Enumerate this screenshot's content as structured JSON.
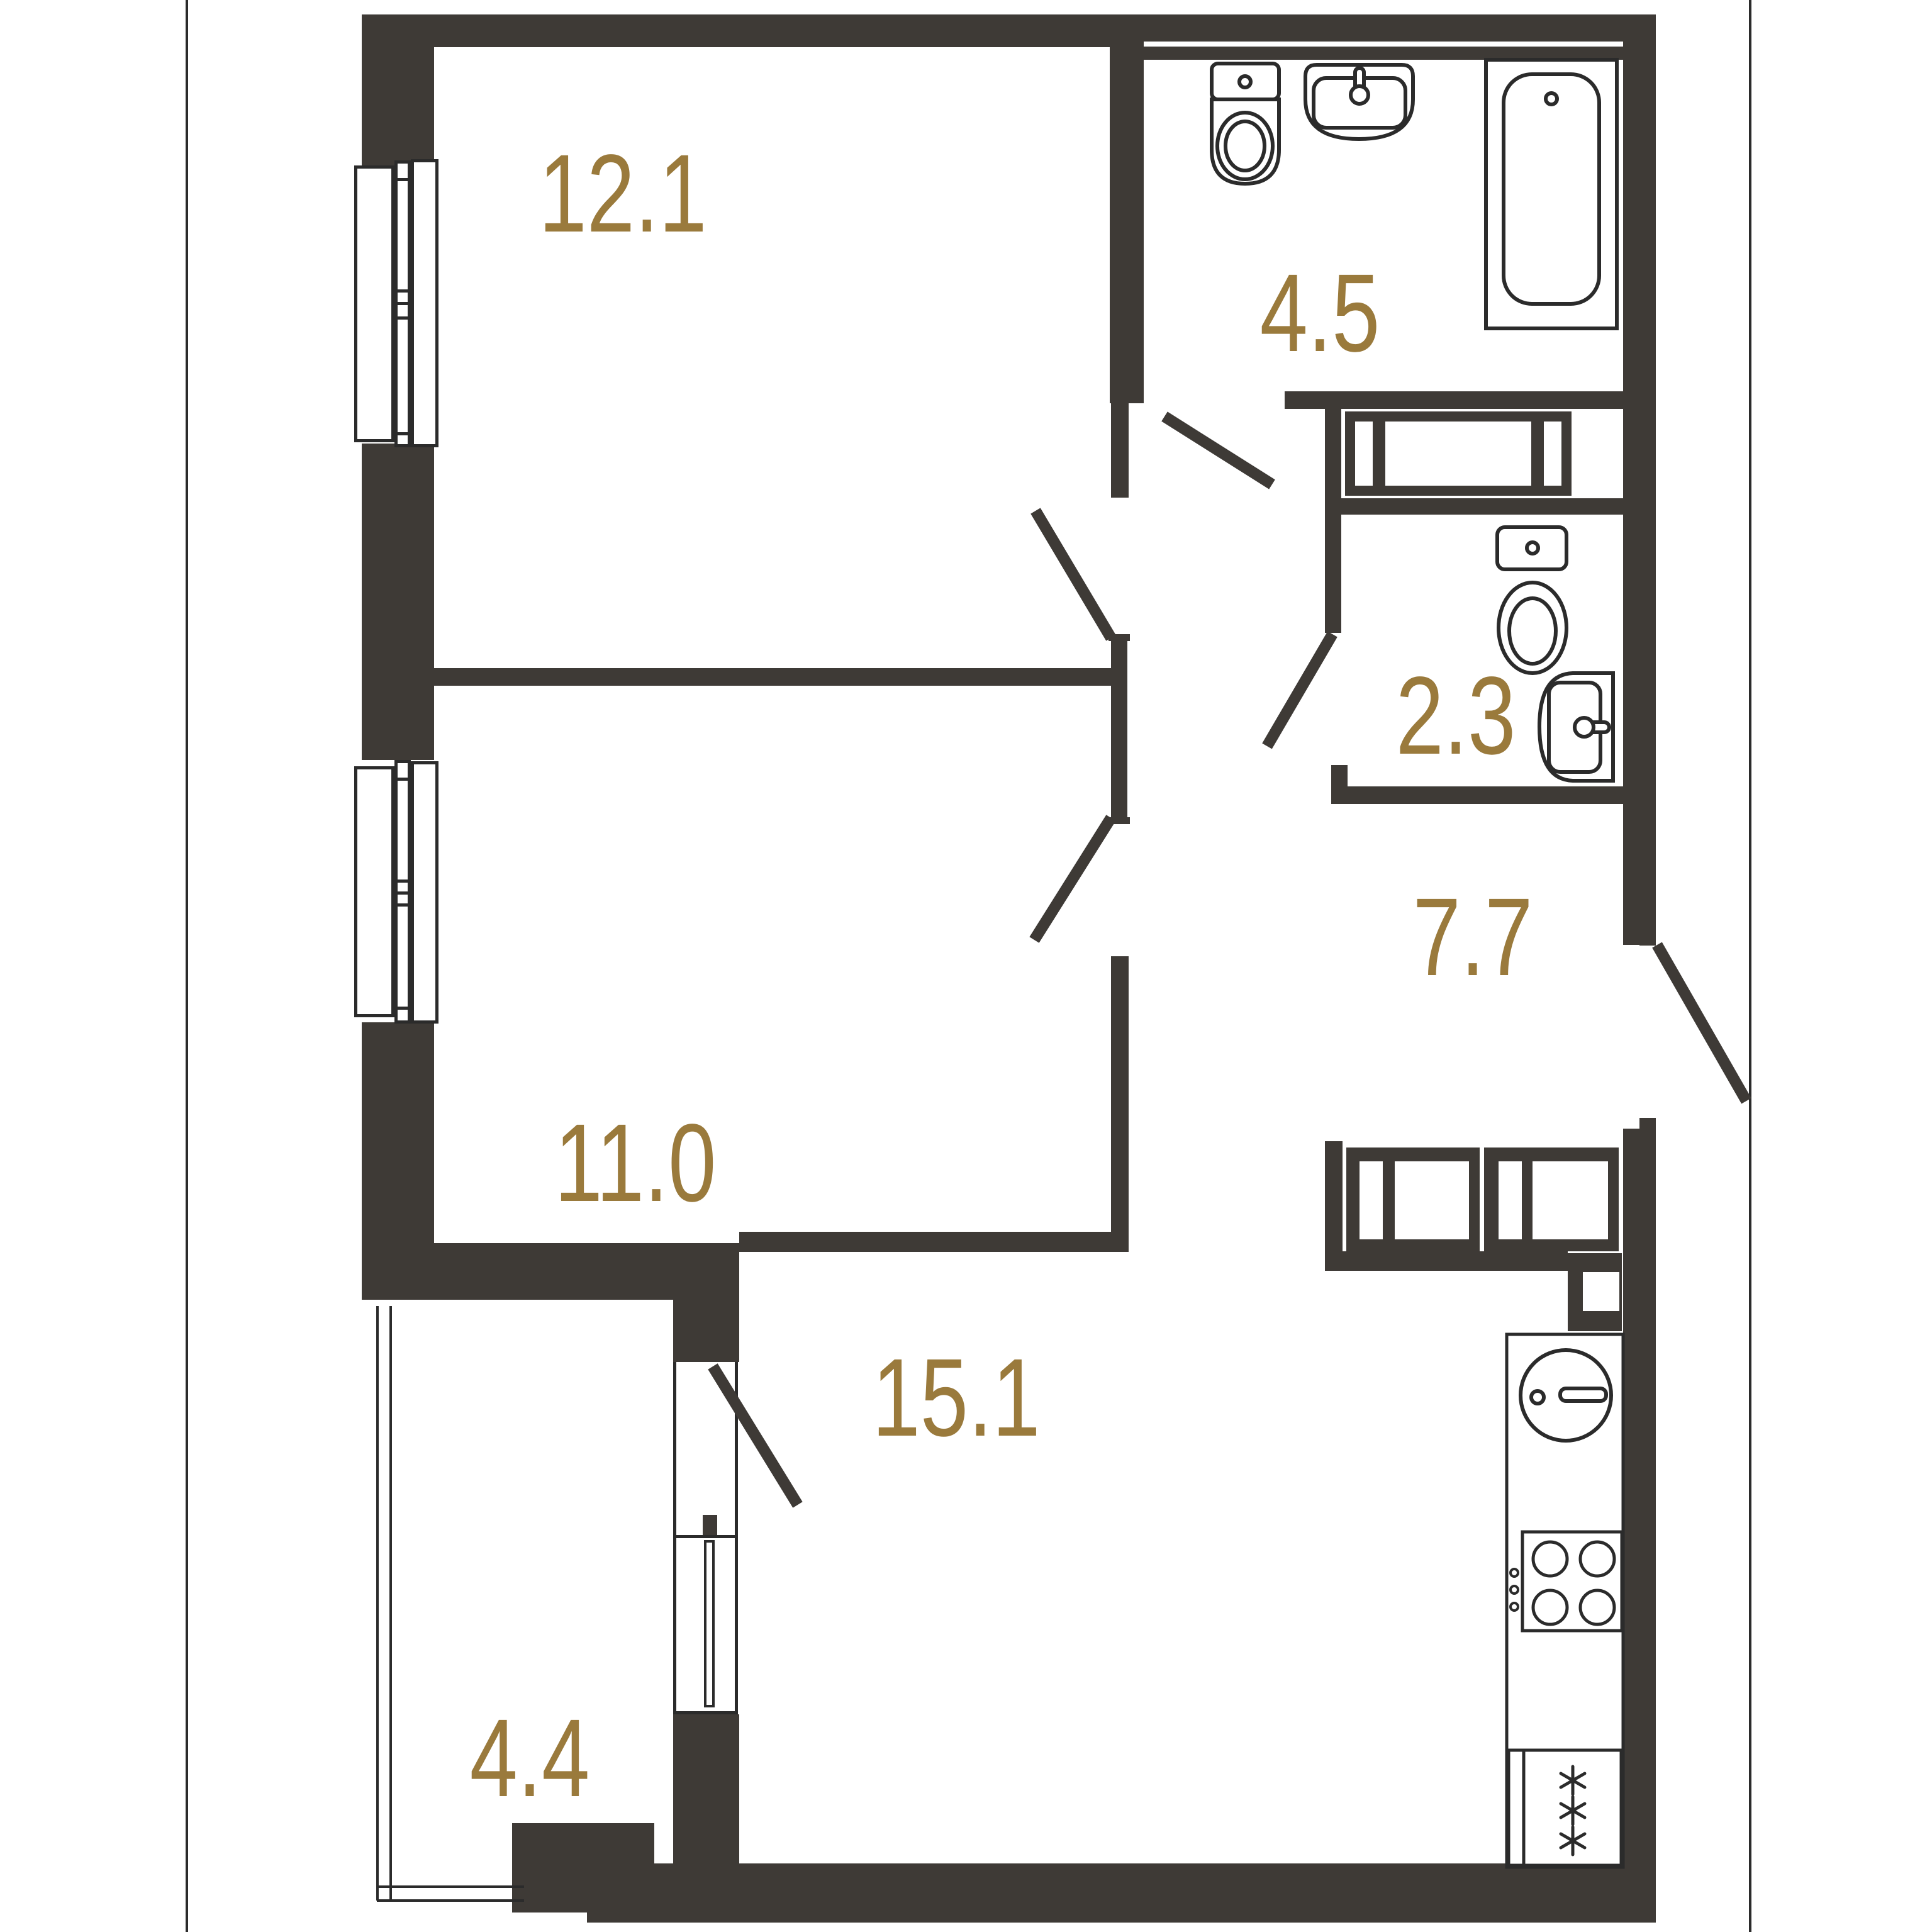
{
  "title": "apartment-floor-plan",
  "colors": {
    "background": "#FFFFFF",
    "wall": "#3E3A36",
    "fixture_line": "#2B2B2B",
    "label": "#9A7A3C"
  },
  "rooms": [
    {
      "id": "living-room",
      "area": "12.1"
    },
    {
      "id": "bathroom",
      "area": "4.5"
    },
    {
      "id": "wc",
      "area": "2.3"
    },
    {
      "id": "hallway",
      "area": "7.7"
    },
    {
      "id": "bedroom",
      "area": "11.0"
    },
    {
      "id": "kitchen-living",
      "area": "15.1"
    },
    {
      "id": "balcony",
      "area": "4.4"
    }
  ],
  "fixtures": [
    "toilet-bathroom",
    "washbasin-bathroom",
    "bathtub",
    "washing-machine-niche",
    "toilet-wc",
    "washbasin-wc",
    "kitchen-cabinets",
    "kitchen-sink",
    "stove-4-burner",
    "refrigerator",
    "windows-left-wall",
    "balcony-glazing",
    "balcony-door-window",
    "interior-doors",
    "entrance-door"
  ]
}
